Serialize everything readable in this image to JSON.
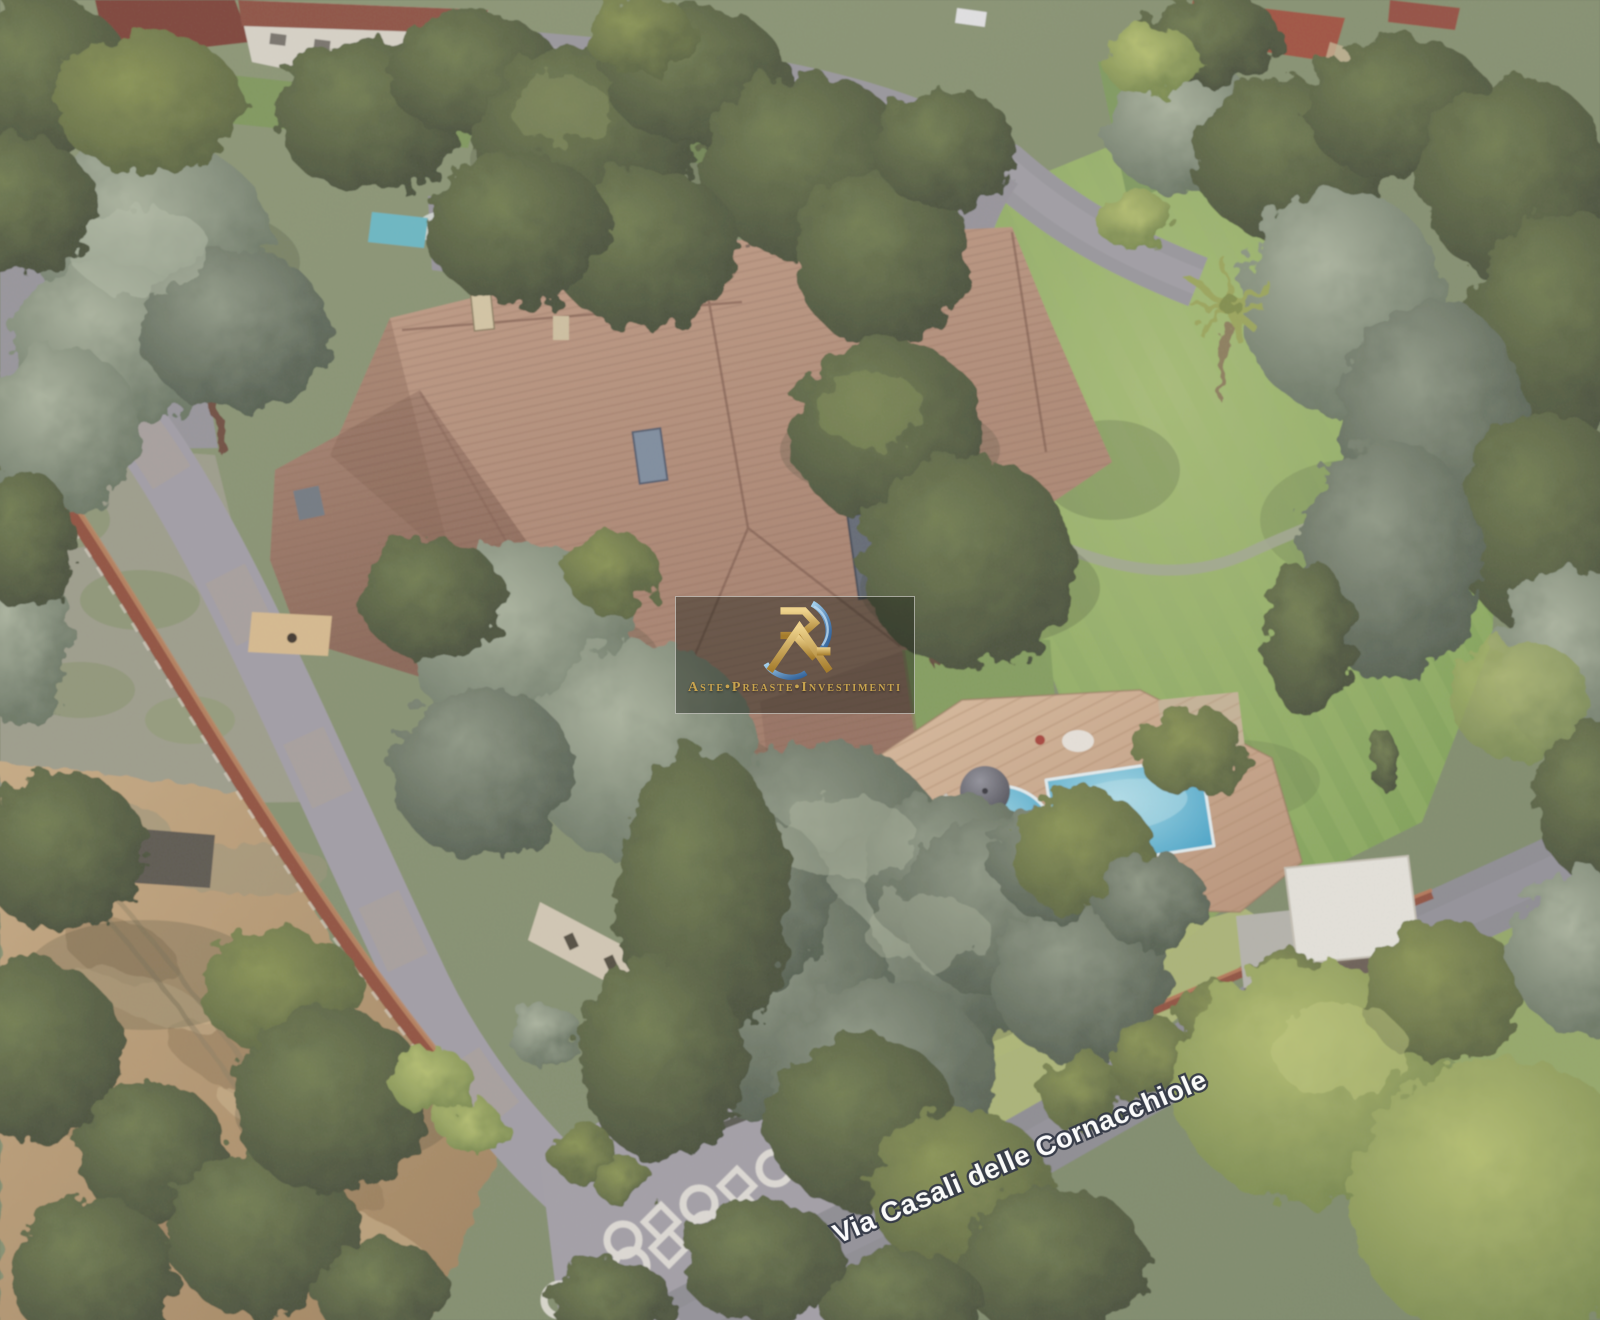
{
  "view": {
    "description": "3D aerial satellite view of a villa estate with terracotta roof, swimming pool, gardens, dirt yard and tree-lined road",
    "street_label": "Via Casali delle Cornacchiole"
  },
  "watermark": {
    "brand": "Aste•Preaste•Investimenti",
    "logo": "ri-monogram-logo"
  },
  "colors": {
    "roof_terracotta": "#a87c68",
    "pool_water": "#47b0d8",
    "deck_wood": "#cfa687",
    "lawn_green": "#8aab5c",
    "tree_dark_olive": "#49523a",
    "tree_gray_green": "#8d9a8a",
    "dirt_ground": "#b9976e",
    "road_asphalt": "#90909a",
    "wall_red_brown": "#8e4a38",
    "watermark_gold": "#c9a44e",
    "swoosh_blue": "#4a7fb5",
    "street_label_text": "#ffffff"
  }
}
